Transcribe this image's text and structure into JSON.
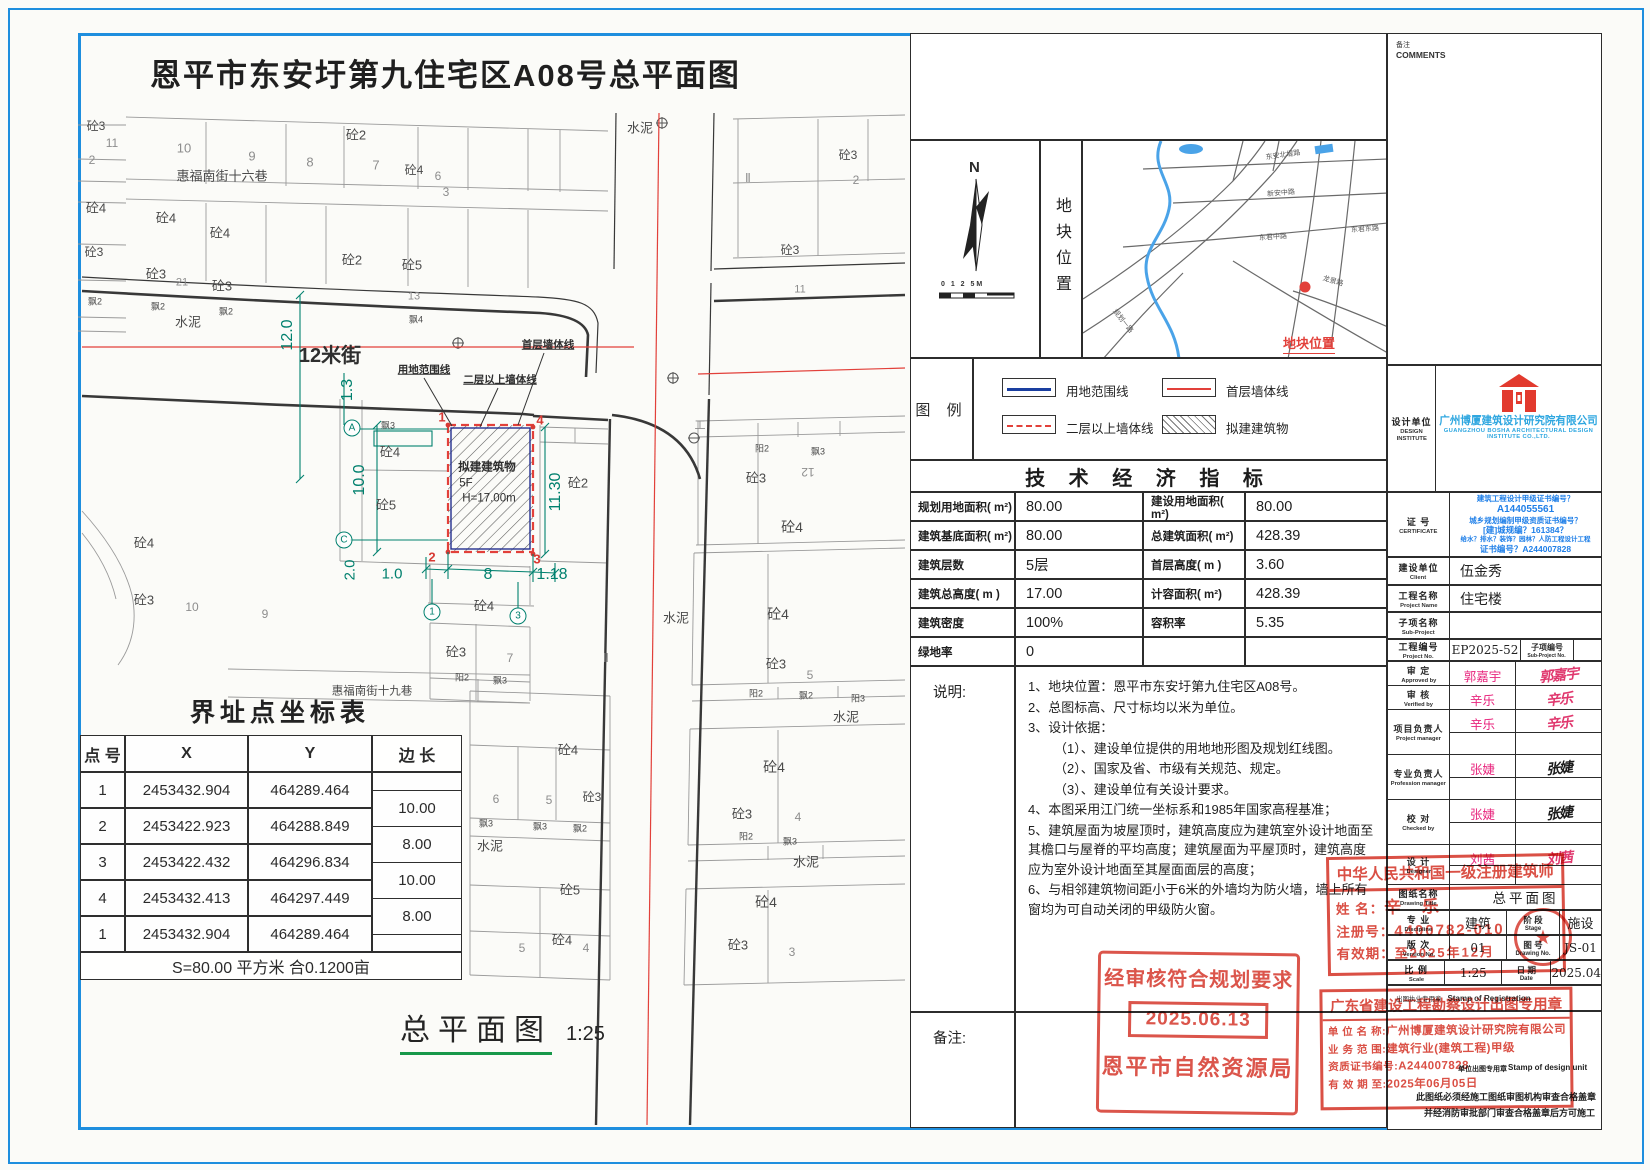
{
  "title": "恩平市东安圩第九住宅区A08号总平面图",
  "plan": {
    "building": [
      "拟建建筑物",
      "5F",
      "H=17.00m"
    ],
    "labels": [
      {
        "t": "砼3",
        "x": 96,
        "y": 126
      },
      {
        "t": "11",
        "x": 112,
        "y": 143,
        "c": "g2"
      },
      {
        "t": "2",
        "x": 92,
        "y": 160,
        "c": "g2"
      },
      {
        "t": "10",
        "x": 184,
        "y": 148,
        "s": 13,
        "c": "g2"
      },
      {
        "t": "9",
        "x": 252,
        "y": 156,
        "s": 13,
        "c": "g2"
      },
      {
        "t": "8",
        "x": 310,
        "y": 162,
        "s": 13,
        "c": "g2"
      },
      {
        "t": "砼2",
        "x": 356,
        "y": 135,
        "s": 13
      },
      {
        "t": "7",
        "x": 376,
        "y": 165,
        "s": 13,
        "c": "g2"
      },
      {
        "t": "砼4",
        "x": 414,
        "y": 170
      },
      {
        "t": "6",
        "x": 438,
        "y": 176,
        "c": "g2"
      },
      {
        "t": "3",
        "x": 446,
        "y": 192,
        "c": "g2"
      },
      {
        "t": "水泥",
        "x": 640,
        "y": 128,
        "s": 13
      },
      {
        "t": "惠福南街十六巷",
        "x": 222,
        "y": 176,
        "s": 13
      },
      {
        "t": "砼4",
        "x": 96,
        "y": 208,
        "s": 13
      },
      {
        "t": "砼4",
        "x": 166,
        "y": 218,
        "s": 13
      },
      {
        "t": "砼4",
        "x": 220,
        "y": 233,
        "s": 13
      },
      {
        "t": "砼2",
        "x": 352,
        "y": 260,
        "s": 13
      },
      {
        "t": "砼5",
        "x": 412,
        "y": 265,
        "s": 13
      },
      {
        "t": "砼3",
        "x": 94,
        "y": 252
      },
      {
        "t": "砼3",
        "x": 156,
        "y": 274,
        "s": 13
      },
      {
        "t": "21",
        "x": 182,
        "y": 283,
        "s": 11,
        "c": "g2"
      },
      {
        "t": "砼3",
        "x": 222,
        "y": 286,
        "s": 13
      },
      {
        "t": "13",
        "x": 414,
        "y": 297,
        "s": 11,
        "c": "g2"
      },
      {
        "t": "飘2",
        "x": 95,
        "y": 302,
        "s": 9
      },
      {
        "t": "飘2",
        "x": 158,
        "y": 307,
        "s": 9
      },
      {
        "t": "飘2",
        "x": 226,
        "y": 312,
        "s": 9
      },
      {
        "t": "飘4",
        "x": 416,
        "y": 320,
        "s": 9
      },
      {
        "t": "水泥",
        "x": 188,
        "y": 322,
        "s": 13
      },
      {
        "t": "Ⅱ",
        "x": 748,
        "y": 178,
        "c": "g2"
      },
      {
        "t": "砼3",
        "x": 848,
        "y": 155
      },
      {
        "t": "2",
        "x": 856,
        "y": 180,
        "c": "g2"
      },
      {
        "t": "砼3",
        "x": 790,
        "y": 250
      },
      {
        "t": "11",
        "x": 800,
        "y": 290,
        "s": 11,
        "c": "g2"
      },
      {
        "t": "12.0",
        "x": 288,
        "y": 335,
        "s": 16,
        "c": "t",
        "r": -90
      },
      {
        "t": "12米街",
        "x": 330,
        "y": 356,
        "s": 20,
        "b": 1,
        "c": "k"
      },
      {
        "t": "1.3",
        "x": 348,
        "y": 390,
        "s": 16,
        "c": "t",
        "r": -90
      },
      {
        "t": "用地范围线",
        "x": 424,
        "y": 370,
        "s": 10.5,
        "b": 1,
        "u": 1,
        "c": "k"
      },
      {
        "t": "二层以上墙体线",
        "x": 500,
        "y": 380,
        "s": 10.5,
        "b": 1,
        "u": 1,
        "c": "k"
      },
      {
        "t": "首层墙体线",
        "x": 548,
        "y": 345,
        "s": 10.5,
        "b": 1,
        "u": 1,
        "c": "k"
      },
      {
        "t": "飘3",
        "x": 388,
        "y": 426,
        "s": 9
      },
      {
        "t": "砼4",
        "x": 390,
        "y": 452,
        "s": 13
      },
      {
        "t": "砼5",
        "x": 386,
        "y": 505,
        "s": 13
      },
      {
        "t": "砼2",
        "x": 578,
        "y": 483,
        "s": 13
      },
      {
        "t": "拟建建筑物",
        "x": 487,
        "y": 468,
        "s": 11.5,
        "b": 1,
        "c": "k"
      },
      {
        "t": "5F",
        "x": 466,
        "y": 484,
        "s": 11.5,
        "c": "k"
      },
      {
        "t": "H=17.00m",
        "x": 489,
        "y": 499,
        "s": 11.5,
        "c": "k"
      },
      {
        "t": "1",
        "x": 442,
        "y": 417,
        "s": 13,
        "c": "r",
        "b": 1
      },
      {
        "t": "4",
        "x": 540,
        "y": 420,
        "s": 13,
        "c": "r",
        "b": 1
      },
      {
        "t": "2",
        "x": 432,
        "y": 557,
        "s": 13,
        "c": "r",
        "b": 1
      },
      {
        "t": "3",
        "x": 537,
        "y": 559,
        "s": 13,
        "c": "r",
        "b": 1
      },
      {
        "t": "10.0",
        "x": 360,
        "y": 480,
        "s": 16,
        "c": "t",
        "r": -90
      },
      {
        "t": "11.30",
        "x": 556,
        "y": 492,
        "s": 16,
        "c": "t",
        "r": -90
      },
      {
        "t": "2.0",
        "x": 350,
        "y": 570,
        "s": 15,
        "c": "t",
        "r": -90
      },
      {
        "t": "1.0",
        "x": 392,
        "y": 574,
        "s": 15,
        "c": "t"
      },
      {
        "t": "8",
        "x": 488,
        "y": 575,
        "s": 16,
        "c": "t"
      },
      {
        "t": "1.18",
        "x": 552,
        "y": 575,
        "s": 16,
        "c": "t"
      },
      {
        "t": "A",
        "x": 352,
        "y": 428,
        "c": "m"
      },
      {
        "t": "C",
        "x": 344,
        "y": 540,
        "c": "m"
      },
      {
        "t": "1",
        "x": 432,
        "y": 612,
        "c": "m"
      },
      {
        "t": "3",
        "x": 518,
        "y": 616,
        "c": "m"
      },
      {
        "t": "砼4",
        "x": 144,
        "y": 543,
        "s": 13
      },
      {
        "t": "砼3",
        "x": 144,
        "y": 600,
        "s": 13
      },
      {
        "t": "10",
        "x": 192,
        "y": 607,
        "c": "g2"
      },
      {
        "t": "9",
        "x": 265,
        "y": 614,
        "c": "g2"
      },
      {
        "t": "砼4",
        "x": 484,
        "y": 606,
        "s": 13
      },
      {
        "t": "砼3",
        "x": 456,
        "y": 652,
        "s": 13
      },
      {
        "t": "7",
        "x": 510,
        "y": 658,
        "c": "g2"
      },
      {
        "t": "Ⅱ",
        "x": 606,
        "y": 658,
        "c": "g2"
      },
      {
        "t": "阳2",
        "x": 462,
        "y": 678,
        "s": 9
      },
      {
        "t": "飘3",
        "x": 500,
        "y": 681,
        "s": 9
      },
      {
        "t": "惠福南街十九巷",
        "x": 372,
        "y": 692,
        "s": 11.5
      },
      {
        "t": "水泥",
        "x": 676,
        "y": 618,
        "s": 13
      },
      {
        "t": "工",
        "x": 700,
        "y": 426,
        "s": 11,
        "c": "g2"
      },
      {
        "t": "阳2",
        "x": 762,
        "y": 449,
        "s": 9
      },
      {
        "t": "飘3",
        "x": 818,
        "y": 452,
        "s": 9
      },
      {
        "t": "砼3",
        "x": 756,
        "y": 478,
        "s": 13
      },
      {
        "t": "12",
        "x": 808,
        "y": 472,
        "c": "g2",
        "r": 180
      },
      {
        "t": "砼4",
        "x": 792,
        "y": 527,
        "s": 14
      },
      {
        "t": "砼4",
        "x": 778,
        "y": 614,
        "s": 14
      },
      {
        "t": "砼3",
        "x": 776,
        "y": 664,
        "s": 13
      },
      {
        "t": "5",
        "x": 810,
        "y": 675,
        "c": "g2"
      },
      {
        "t": "阳2",
        "x": 756,
        "y": 694,
        "s": 9
      },
      {
        "t": "飘2",
        "x": 806,
        "y": 696,
        "s": 9
      },
      {
        "t": "阳3",
        "x": 858,
        "y": 699,
        "s": 9
      },
      {
        "t": "水泥",
        "x": 846,
        "y": 717,
        "s": 13
      },
      {
        "t": "砼4",
        "x": 774,
        "y": 767,
        "s": 14
      },
      {
        "t": "砼3",
        "x": 742,
        "y": 814,
        "s": 13
      },
      {
        "t": "4",
        "x": 798,
        "y": 817,
        "c": "g2"
      },
      {
        "t": "阳2",
        "x": 746,
        "y": 837,
        "s": 9
      },
      {
        "t": "飘3",
        "x": 790,
        "y": 842,
        "s": 9
      },
      {
        "t": "水泥",
        "x": 806,
        "y": 862,
        "s": 13
      },
      {
        "t": "砼4",
        "x": 766,
        "y": 902,
        "s": 14
      },
      {
        "t": "砼3",
        "x": 738,
        "y": 945,
        "s": 13
      },
      {
        "t": "3",
        "x": 792,
        "y": 952,
        "c": "g2"
      },
      {
        "t": "砼4",
        "x": 568,
        "y": 750,
        "s": 13
      },
      {
        "t": "6",
        "x": 496,
        "y": 799,
        "c": "g2"
      },
      {
        "t": "5",
        "x": 549,
        "y": 800,
        "c": "g2"
      },
      {
        "t": "砼3",
        "x": 592,
        "y": 797
      },
      {
        "t": "飘3",
        "x": 486,
        "y": 824,
        "s": 9
      },
      {
        "t": "飘3",
        "x": 540,
        "y": 827,
        "s": 9
      },
      {
        "t": "飘2",
        "x": 580,
        "y": 829,
        "s": 9
      },
      {
        "t": "水泥",
        "x": 490,
        "y": 846,
        "s": 13
      },
      {
        "t": "砼5",
        "x": 570,
        "y": 890,
        "s": 13
      },
      {
        "t": "砼4",
        "x": 562,
        "y": 940,
        "s": 13
      },
      {
        "t": "4",
        "x": 586,
        "y": 948,
        "c": "g2"
      },
      {
        "t": "5",
        "x": 522,
        "y": 948,
        "c": "g2"
      }
    ]
  },
  "coord_table": {
    "title": "界址点坐标表",
    "headers": [
      "点 号",
      "X",
      "Y",
      "边 长"
    ],
    "rows": [
      [
        "1",
        "2453432.904",
        "464289.464"
      ],
      [
        "2",
        "2453422.923",
        "464288.849"
      ],
      [
        "3",
        "2453422.432",
        "464296.834"
      ],
      [
        "4",
        "2453432.413",
        "464297.449"
      ],
      [
        "1",
        "2453432.904",
        "464289.464"
      ]
    ],
    "edges": [
      "10.00",
      "8.00",
      "10.00",
      "8.00"
    ],
    "footer": "S=80.00 平方米 合0.1200亩"
  },
  "plan_footer": {
    "label": "总平面图",
    "scale": "1:25"
  },
  "location": {
    "north": "N",
    "scale_text": "0  1  2       5M",
    "side_label": "地块位置",
    "marker_label": "地块位置",
    "map_labels": [
      {
        "t": "东安北堤路",
        "x": 200,
        "y": 14,
        "r": -8
      },
      {
        "t": "新安中路",
        "x": 198,
        "y": 52,
        "r": -5
      },
      {
        "t": "东君中路",
        "x": 190,
        "y": 96,
        "r": -4
      },
      {
        "t": "东君东路",
        "x": 282,
        "y": 88,
        "r": -4
      },
      {
        "t": "龙景路",
        "x": 250,
        "y": 140,
        "r": 16
      },
      {
        "t": "规划一路",
        "x": 40,
        "y": 180,
        "r": 52
      }
    ]
  },
  "legend": {
    "title": "图 例",
    "items": [
      {
        "label": "用地范围线",
        "type": "blue-solid"
      },
      {
        "label": "首层墙体线",
        "type": "red-solid"
      },
      {
        "label": "二层以上墙体线",
        "type": "red-dashed"
      },
      {
        "label": "拟建建筑物",
        "type": "hatch"
      }
    ]
  },
  "indicators": {
    "title": "技 术 经 济 指 标",
    "rows": [
      [
        "规划用地面积( m²)",
        "80.00",
        "建设用地面积( m²)",
        "80.00"
      ],
      [
        "建筑基底面积( m²)",
        "80.00",
        "总建筑面积( m²)",
        "428.39"
      ],
      [
        "建筑层数",
        "5层",
        "首层高度( m )",
        "3.60"
      ],
      [
        "建筑总高度( m )",
        "17.00",
        "计容面积( m²)",
        "428.39"
      ],
      [
        "建筑密度",
        "100%",
        "容积率",
        "5.35"
      ],
      [
        "绿地率",
        "0",
        "",
        ""
      ]
    ]
  },
  "notes": {
    "label": "说明:",
    "lines": [
      "1、地块位置：恩平市东安圩第九住宅区A08号。",
      "2、总图标高、尺寸标均以米为单位。",
      "3、设计依据：",
      "（1）、建设单位提供的用地地形图及规划红线图。",
      "（2）、国家及省、市级有关规范、规定。",
      "（3）、建设单位有关设计要求。",
      "4、本图采用江门统一坐标系和1985年国家高程基准；",
      "5、建筑屋面为坡屋顶时，建筑高度应为建筑室外设计地面至其檐口与屋脊的平均高度；建筑屋面为平屋顶时，建筑高度应为室外设计地面至其屋面面层的高度；",
      "6、与相邻建筑物间距小于6米的外墙均为防火墙，墙上所有窗均为可自动关闭的甲级防火窗。"
    ]
  },
  "remark_label": "备注:",
  "comments": {
    "zh": "备注",
    "en": "COMMENTS"
  },
  "titleblock": {
    "design_unit": {
      "zh": "设计单位",
      "en1": "DESIGN",
      "en2": "INSTITUTE"
    },
    "company": {
      "zh": "广州博厦建筑设计研究院有限公司",
      "en1": "GUANGZHOU BOSHA ARCHITECTURAL DESIGN",
      "en2": "INSTITUTE CO.,LTD."
    },
    "certificate": {
      "zh": "证 号",
      "en": "CERTIFICATE",
      "lines": [
        "建筑工程设计甲级证书编号？",
        "A144055561",
        "城乡规划编制甲级资质证书编号？",
        "[建]城规编？161384？",
        "给水？排水？装饰？园林？人防工程设计工程",
        "证书编号？A244007828"
      ]
    },
    "client": {
      "zh": "建设单位",
      "en": "Client",
      "value": "伍金秀"
    },
    "project": {
      "zh": "工程名称",
      "en": "Project Name",
      "value": "住宅楼"
    },
    "subproject": {
      "zh": "子项名称",
      "en": "Sub-Project",
      "value": ""
    },
    "project_no": {
      "zh": "工程编号",
      "en": "Project No.",
      "value": "EP2025-52",
      "zh2": "子项编号",
      "en2": "Sub-Project No."
    },
    "personnel": [
      {
        "zh": "审 定",
        "en": "Approved by",
        "name": "郭嘉宇",
        "sig": "郭嘉宇",
        "sc": "p",
        "h": 24
      },
      {
        "zh": "审 核",
        "en": "Verified by",
        "name": "辛乐",
        "sig": "辛乐",
        "sc": "p",
        "h": 24
      },
      {
        "zh": "项目负责人",
        "en": "Project manager",
        "name": "辛乐",
        "sig": "辛乐",
        "sc": "p",
        "h": 45,
        "two": 1
      },
      {
        "zh": "专业负责人",
        "en": "Profession manager",
        "name": "张婕",
        "sig": "张婕",
        "sc": "k",
        "h": 45,
        "two": 1
      },
      {
        "zh": "校 对",
        "en": "Checked by",
        "name": "张婕",
        "sig": "张婕",
        "sc": "k",
        "h": 45,
        "two": 1
      },
      {
        "zh": "设 计",
        "en": "Designer",
        "name": "刘茜",
        "sig": "刘茜",
        "sc": "p",
        "h": 40,
        "two": 1
      }
    ],
    "drawing_title": {
      "zh": "图纸名称",
      "en": "Drawing Title",
      "value": "总平面图"
    },
    "discipline": {
      "zh": "专 业",
      "en": "Discipline",
      "value": "建筑",
      "zh2": "阶 段",
      "en2": "Stage",
      "value2": "施设"
    },
    "version": {
      "zh": "版 次",
      "en": "Version No.",
      "value": "01",
      "zh2": "图 号",
      "en2": "Drawing No.",
      "value2": "JS-01"
    },
    "scale": {
      "zh": "比 例",
      "en": "Scale",
      "value": "1:25",
      "zh2": "日 期",
      "en2": "Date",
      "value2": "2025.04"
    },
    "reg_row": {
      "zh": "出图执业专用章",
      "en": "Stamp of Registration"
    },
    "unit_note": {
      "zh": "单位出图专用章",
      "en": "Stamp of design unit",
      "n1": "此图纸必须经施工图纸审图机构审查合格盖章",
      "n2": "并经消防审批部门审查合格盖章后方可施工"
    }
  },
  "stamps": {
    "approval": {
      "line1": "经审核符合规划要求",
      "date": "2025.06.13",
      "line3": "恩平市自然资源局"
    },
    "architect": {
      "title": "中华人民共和国一级注册建筑师",
      "name_label": "姓  名：",
      "name": "辛 乐",
      "reg_label": "注册号：",
      "reg": "4400782-010",
      "valid_label": "有效期：",
      "valid": "至2025年12月"
    },
    "gd": {
      "title": "广东省建设工程勘察设计出图专用章",
      "rows": [
        [
          "单 位 名 称:",
          "广州博厦建筑设计研究院有限公司"
        ],
        [
          "业 务 范 围:",
          "建筑行业(建筑工程)甲级"
        ],
        [
          "资质证书编号:",
          "A244007828"
        ],
        [
          "有 效 期 至:",
          "2025年06月05日"
        ]
      ]
    }
  },
  "colors": {
    "frame_blue": "#1e8ede",
    "stamp_red": "#d8463b",
    "dim_teal": "#00806e",
    "line_red": "#e2403a"
  }
}
